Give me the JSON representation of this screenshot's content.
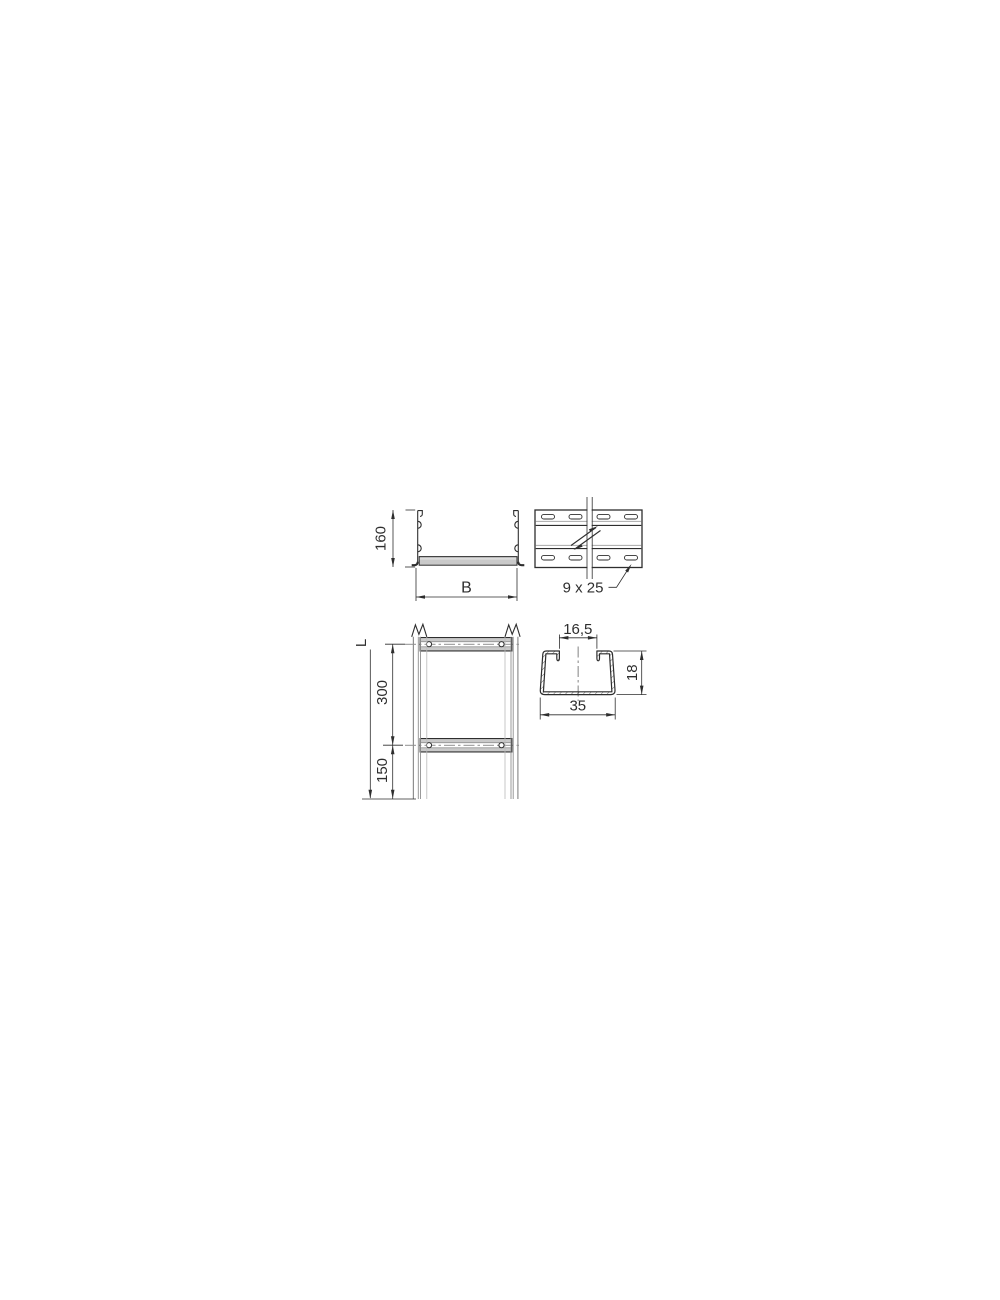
{
  "colors": {
    "background": "#ffffff",
    "line": "#2e2e2e",
    "metal": "#c9c9c9",
    "light": "#a8a8a8",
    "rail": "#8f8f8f",
    "rail_light": "#b9b9b9"
  },
  "views": {
    "cross_section": {
      "height_label": "160",
      "width_label": "B"
    },
    "side_view": {
      "slot_label": "9 x 25"
    },
    "plan_view": {
      "length_label": "L",
      "rung_spacing_label": "300",
      "end_offset_label": "150"
    },
    "rung_section": {
      "opening_label": "16,5",
      "height_label": "18",
      "width_label": "35"
    }
  }
}
